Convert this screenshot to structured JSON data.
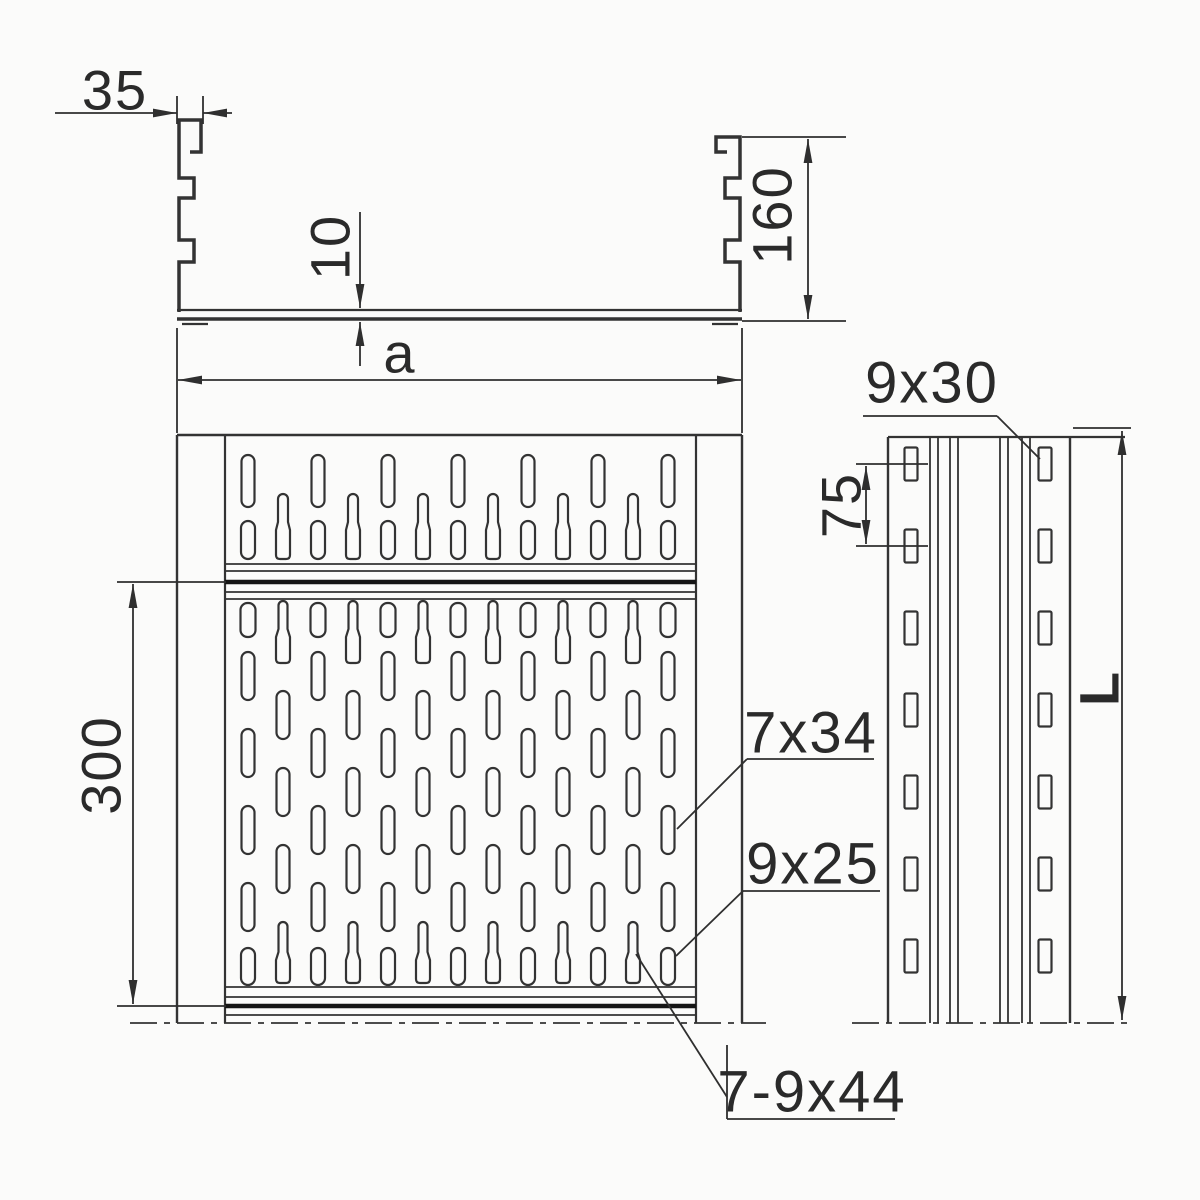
{
  "title": "Perforated cable tray technical drawing",
  "labels": {
    "flange_width": "35",
    "bottom_thickness": "10",
    "side_height": "160",
    "tray_width": "a",
    "pattern_length": "300",
    "side_slot_size": "9x30",
    "side_slot_spacing": "75",
    "tray_length": "L",
    "slot_long": "7x34",
    "slot_short": "9x25",
    "slot_keyhole": "7-9x44"
  },
  "colors": {
    "line": "#333333",
    "thick_line": "#151515",
    "dim_line": "#2f2f2f",
    "text": "#2a2a2a",
    "background": "#fbfbfa"
  },
  "drawing": {
    "plan": {
      "colsA": [
        248,
        318,
        388,
        458,
        528,
        598,
        668
      ],
      "colsB": [
        283,
        353,
        423,
        493,
        563,
        633
      ],
      "rowsA": [
        {
          "type": "slot",
          "y1": 455,
          "y2": 507,
          "w": 13
        },
        {
          "type": "slot",
          "y1": 521,
          "y2": 559,
          "w": 14
        },
        {
          "type": "slot",
          "y1": 603,
          "y2": 637,
          "w": 15
        },
        {
          "type": "slot",
          "y1": 652,
          "y2": 700,
          "w": 13
        },
        {
          "type": "slot",
          "y1": 729,
          "y2": 777,
          "w": 13
        },
        {
          "type": "slot",
          "y1": 806,
          "y2": 854,
          "w": 13
        },
        {
          "type": "slot",
          "y1": 883,
          "y2": 931,
          "w": 13
        },
        {
          "type": "slot",
          "y1": 948,
          "y2": 985,
          "w": 14
        }
      ],
      "rowsB": [
        {
          "type": "keyhole",
          "y1": 494,
          "y2": 559,
          "neck": 32,
          "nw": 10,
          "bw": 14
        },
        {
          "type": "keyhole",
          "y1": 601,
          "y2": 663,
          "neck": 32,
          "nw": 9,
          "bw": 14
        },
        {
          "type": "slot",
          "y1": 691,
          "y2": 739,
          "w": 13
        },
        {
          "type": "slot",
          "y1": 768,
          "y2": 816,
          "w": 13
        },
        {
          "type": "slot",
          "y1": 845,
          "y2": 893,
          "w": 13
        },
        {
          "type": "keyhole",
          "y1": 922,
          "y2": 983,
          "neck": 34,
          "nw": 9,
          "bw": 14
        }
      ]
    },
    "side": {
      "cols": [
        911,
        1045
      ],
      "centers": [
        464,
        546,
        628,
        710,
        792,
        874,
        956
      ],
      "w": 13,
      "h": 33
    }
  }
}
